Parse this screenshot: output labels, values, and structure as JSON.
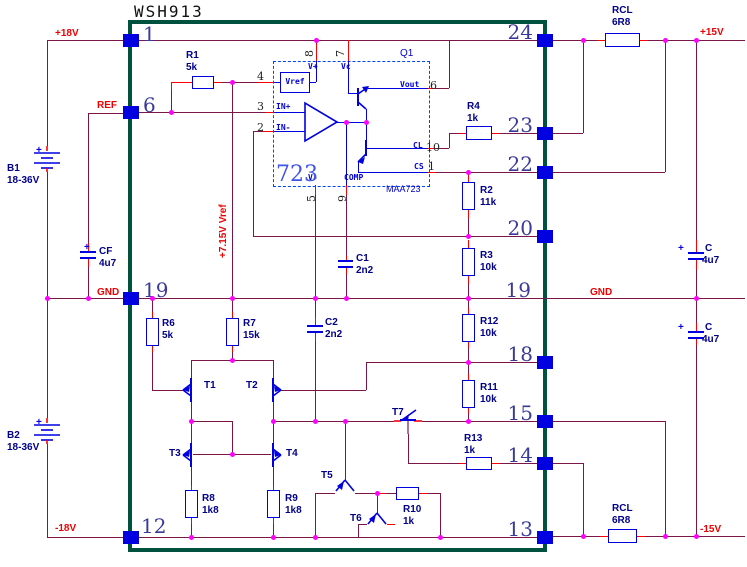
{
  "title": "WSH913",
  "pins_left": [
    "1",
    "6",
    "19",
    "12"
  ],
  "pins_right": [
    "24",
    "23",
    "22",
    "20",
    "19",
    "18",
    "15",
    "14",
    "13"
  ],
  "nets": {
    "p18v": "+18V",
    "ref": "REF",
    "gnd_left": "GND",
    "m18v": "-18V",
    "p15v": "+15V",
    "gnd_right": "GND",
    "m15v": "-15V",
    "vref_rail": "+7.15V Vref"
  },
  "ic723": {
    "designator": "Q1",
    "core": "723",
    "part": "MAA723",
    "ports": {
      "vref": "Vref",
      "vplus": "V+",
      "vc": "Vc",
      "vout": "Vout",
      "cl": "CL",
      "cs": "CS",
      "vminus": "V-",
      "comp": "COMP",
      "in_p": "IN+",
      "in_n": "IN-"
    },
    "pins": {
      "vref": "4",
      "in_p": "3",
      "in_n": "2",
      "vplus": "8",
      "vc": "7",
      "vout": "6",
      "cl": "10",
      "cs": "1",
      "vminus": "5",
      "comp": "9"
    }
  },
  "components": {
    "b1": {
      "ref": "B1",
      "value": "18-36V",
      "polarity": "+"
    },
    "b2": {
      "ref": "B2",
      "value": "18-36V",
      "polarity": "+"
    },
    "cf": {
      "ref": "CF",
      "value": "4u7",
      "polarity": "+"
    },
    "c_pos_rail": {
      "ref": "C",
      "value": "4u7",
      "polarity": "+"
    },
    "c_neg_rail": {
      "ref": "C",
      "value": "4u7",
      "polarity": "+"
    },
    "c1": {
      "ref": "C1",
      "value": "2n2"
    },
    "c2": {
      "ref": "C2",
      "value": "2n2"
    },
    "r1": {
      "ref": "R1",
      "value": "5k"
    },
    "r2": {
      "ref": "R2",
      "value": "11k"
    },
    "r3": {
      "ref": "R3",
      "value": "10k"
    },
    "r4": {
      "ref": "R4",
      "value": "1k"
    },
    "r6": {
      "ref": "R6",
      "value": "5k"
    },
    "r7": {
      "ref": "R7",
      "value": "15k"
    },
    "r8": {
      "ref": "R8",
      "value": "1k8"
    },
    "r9": {
      "ref": "R9",
      "value": "1k8"
    },
    "r10": {
      "ref": "R10",
      "value": "1k"
    },
    "r11": {
      "ref": "R11",
      "value": "10k"
    },
    "r12": {
      "ref": "R12",
      "value": "10k"
    },
    "r13": {
      "ref": "R13",
      "value": "1k"
    },
    "rcl_top": {
      "ref": "RCL",
      "value": "6R8"
    },
    "rcl_bot": {
      "ref": "RCL",
      "value": "6R8"
    },
    "t1": {
      "ref": "T1"
    },
    "t2": {
      "ref": "T2"
    },
    "t3": {
      "ref": "T3"
    },
    "t4": {
      "ref": "T4"
    },
    "t5": {
      "ref": "T5"
    },
    "t6": {
      "ref": "T6"
    },
    "t7": {
      "ref": "T7"
    }
  }
}
